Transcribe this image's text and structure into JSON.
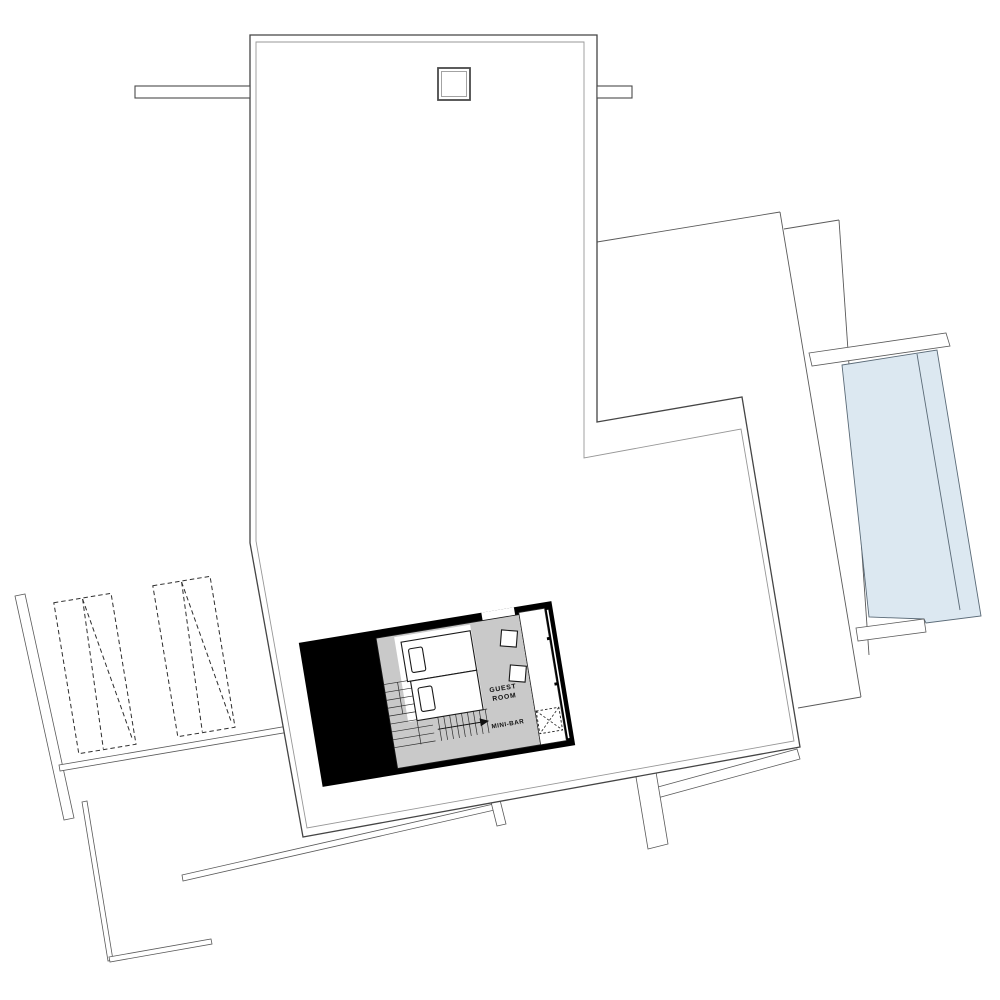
{
  "labels": {
    "guest_room_line1": "GUEST",
    "guest_room_line2": "ROOM",
    "minibar": "MINI-BAR"
  },
  "colors": {
    "background": "#ffffff",
    "line": "#4a4a4a",
    "line_inner": "#979797",
    "block_black": "#000000",
    "room_gray": "#c9c9c9",
    "pool_blue": "#dce8f1",
    "pool_edge": "#5a6a77",
    "text": "#111111"
  }
}
